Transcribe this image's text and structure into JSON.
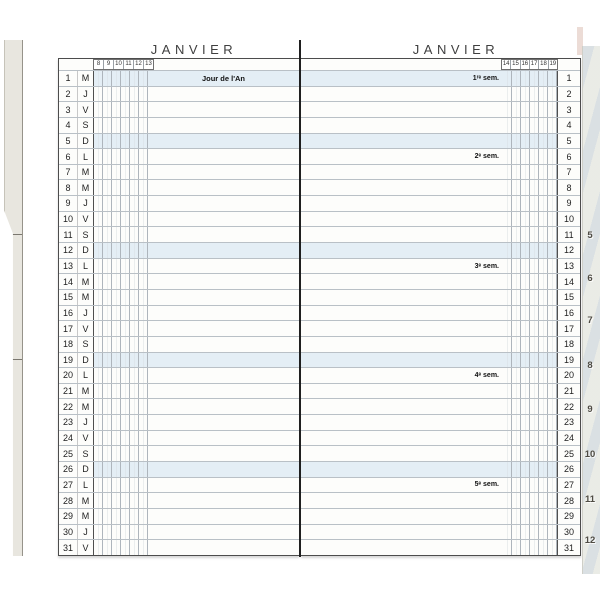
{
  "left_page": {
    "title": "JANVIER",
    "hours": [
      "8",
      "9",
      "10",
      "11",
      "12",
      "13"
    ]
  },
  "right_page": {
    "title": "JANVIER",
    "hours": [
      "14",
      "15",
      "16",
      "17",
      "18",
      "19"
    ]
  },
  "days": [
    {
      "num": "1",
      "letter": "M",
      "shaded": true,
      "left_note": "Jour de l'An",
      "right_note": "1ʳᵉ sem."
    },
    {
      "num": "2",
      "letter": "J"
    },
    {
      "num": "3",
      "letter": "V"
    },
    {
      "num": "4",
      "letter": "S"
    },
    {
      "num": "5",
      "letter": "D",
      "shaded": true
    },
    {
      "num": "6",
      "letter": "L",
      "right_note": "2ᵉ sem."
    },
    {
      "num": "7",
      "letter": "M"
    },
    {
      "num": "8",
      "letter": "M"
    },
    {
      "num": "9",
      "letter": "J"
    },
    {
      "num": "10",
      "letter": "V"
    },
    {
      "num": "11",
      "letter": "S"
    },
    {
      "num": "12",
      "letter": "D",
      "shaded": true
    },
    {
      "num": "13",
      "letter": "L",
      "right_note": "3ᵉ sem."
    },
    {
      "num": "14",
      "letter": "M"
    },
    {
      "num": "15",
      "letter": "M"
    },
    {
      "num": "16",
      "letter": "J"
    },
    {
      "num": "17",
      "letter": "V"
    },
    {
      "num": "18",
      "letter": "S"
    },
    {
      "num": "19",
      "letter": "D",
      "shaded": true
    },
    {
      "num": "20",
      "letter": "L",
      "right_note": "4ᵉ sem."
    },
    {
      "num": "21",
      "letter": "M"
    },
    {
      "num": "22",
      "letter": "M"
    },
    {
      "num": "23",
      "letter": "J"
    },
    {
      "num": "24",
      "letter": "V"
    },
    {
      "num": "25",
      "letter": "S"
    },
    {
      "num": "26",
      "letter": "D",
      "shaded": true
    },
    {
      "num": "27",
      "letter": "L",
      "right_note": "5ᵉ sem."
    },
    {
      "num": "28",
      "letter": "M"
    },
    {
      "num": "29",
      "letter": "M"
    },
    {
      "num": "30",
      "letter": "J"
    },
    {
      "num": "31",
      "letter": "V"
    }
  ],
  "edge_tabs": [
    "5",
    "6",
    "7",
    "8",
    "9",
    "10",
    "11",
    "12"
  ],
  "colors": {
    "sunday_shade": "#e4eef5",
    "hour_line": "#aeb5bc",
    "half_hour_line": "#d9dee2",
    "border_dark": "#4c4c4c",
    "tab_text": "#4f4c44",
    "page_edge": "#eaebe6"
  }
}
